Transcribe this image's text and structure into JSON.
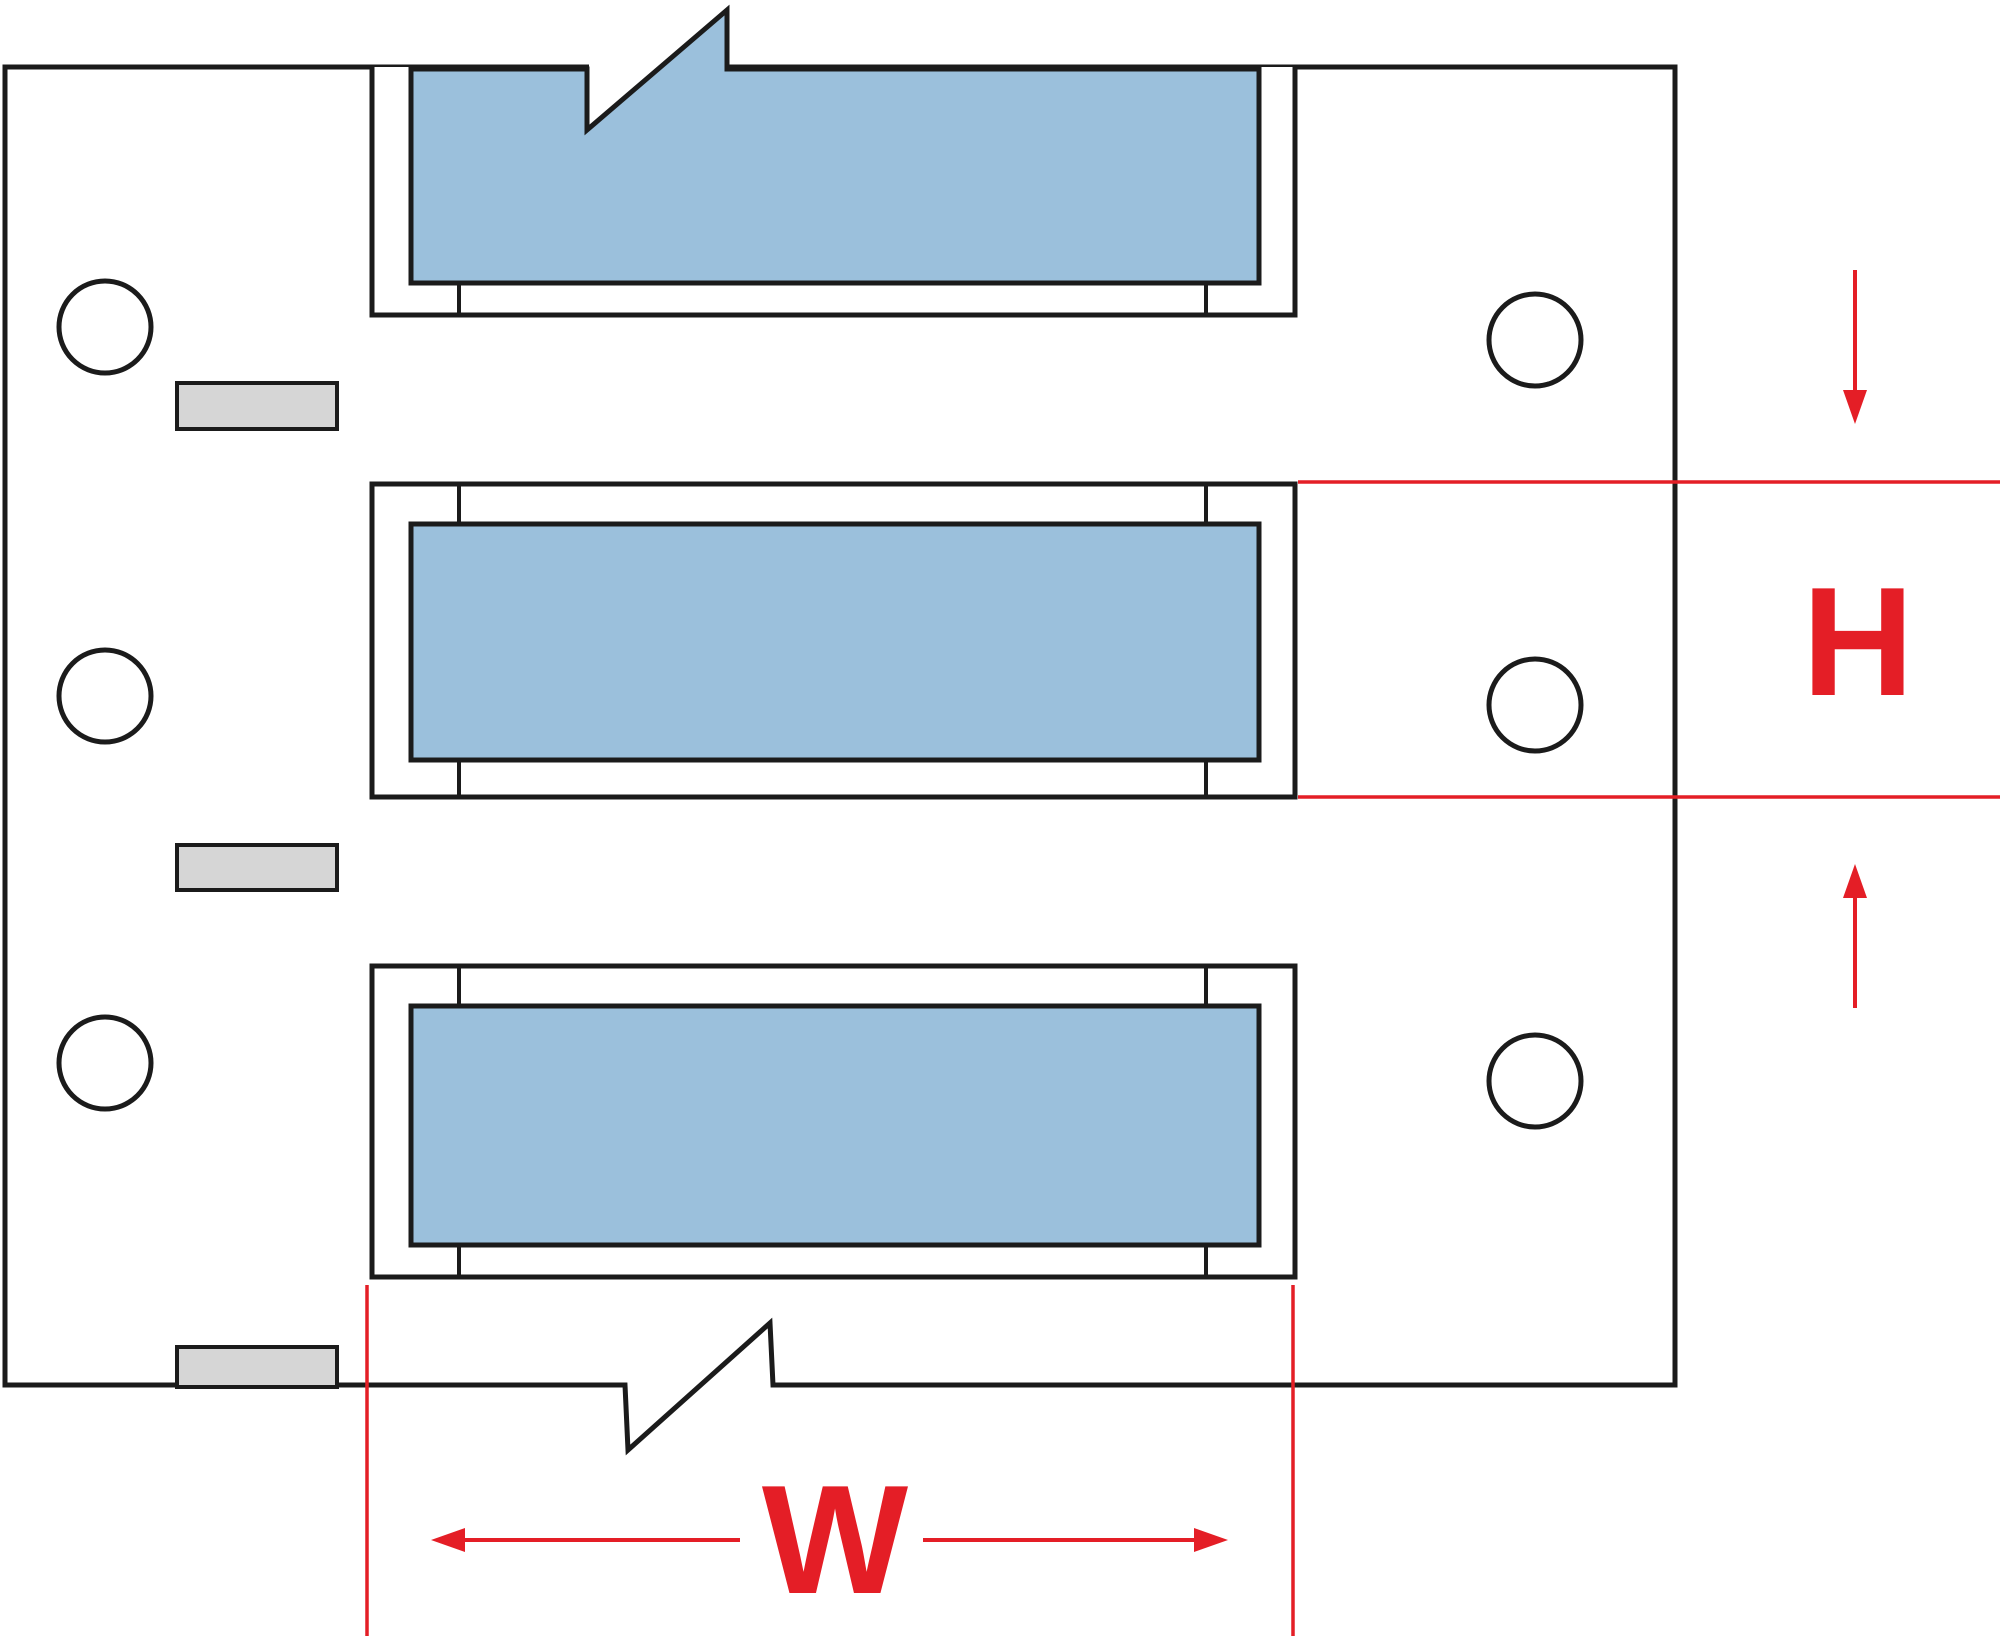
{
  "figure": {
    "description": "Dimensional line drawing of heat-shrink wire marker sleeves on a perforated printer liner, with three blue sleeves, six feed holes, three gray registration marks, break (continuation) zigzags, and red dimension callouts for sleeve width and height",
    "sleeve_count": 3,
    "feed_hole_count": 6,
    "registration_mark_count": 3
  },
  "dimensions": {
    "height_label": "H",
    "width_label": "W"
  },
  "colors": {
    "sleeve_blue": "#9bc0dc",
    "liner_gray": "#d6d6d6",
    "dimension_red": "#e41e26",
    "line_black": "#1b1b1b",
    "background": "#ffffff"
  }
}
